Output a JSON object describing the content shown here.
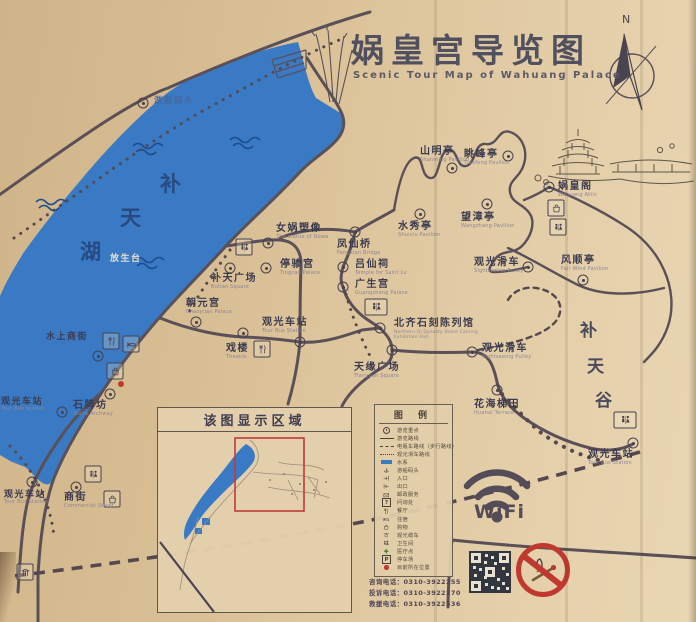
{
  "title": {
    "cn": "娲皇宫导览图",
    "en": "Scenic Tour Map of Wahuang Palace"
  },
  "compass": {
    "north": "N"
  },
  "lake": {
    "chars": [
      "补",
      "天",
      "湖"
    ],
    "color": "#3a7ac4"
  },
  "valley": {
    "chars": [
      "补",
      "天",
      "谷"
    ]
  },
  "pois": [
    {
      "cn": "游船码头",
      "en": ""
    },
    {
      "cn": "山明亭",
      "en": "Shanming Pavilion"
    },
    {
      "cn": "眺峰亭",
      "en": "Tiaofeng Pavilion"
    },
    {
      "cn": "娲皇阁",
      "en": "Wahuang Attic"
    },
    {
      "cn": "望漳亭",
      "en": "Wangzhang Pavilion"
    },
    {
      "cn": "水秀亭",
      "en": "Shuixiu Pavilion"
    },
    {
      "cn": "风顺亭",
      "en": "Fair Wind Pavilion"
    },
    {
      "cn": "观光滑车",
      "en": "Sightseeing Pulley"
    },
    {
      "cn": "女娲塑像",
      "en": "The statue of Nüwa"
    },
    {
      "cn": "凤仙桥",
      "en": "Fengxian Bridge"
    },
    {
      "cn": "停骖宫",
      "en": "Tingcan Palace"
    },
    {
      "cn": "吕仙祠",
      "en": "Temple for Saint Lu"
    },
    {
      "cn": "补天广场",
      "en": "Butian Square"
    },
    {
      "cn": "广生宫",
      "en": "Guangsheng Palace"
    },
    {
      "cn": "朝元宫",
      "en": "Chaoyuan Palace"
    },
    {
      "cn": "观光车站",
      "en": "Tour Bus Station"
    },
    {
      "cn": "戏楼",
      "en": "Theatre"
    },
    {
      "cn": "北齐石刻陈列馆",
      "en": "Northern Qi Dynasty Stone Carving Exhibition Hall"
    },
    {
      "cn": "天缘广场",
      "en": "Tianyuan Square"
    },
    {
      "cn": "观光滑车",
      "en": "Sightseeing Pulley"
    },
    {
      "cn": "花海梯田",
      "en": "Huahai Terrace"
    },
    {
      "cn": "石牌坊",
      "en": "Stone Archway"
    },
    {
      "cn": "观光车站",
      "en": "Tour Bus Station"
    },
    {
      "cn": "水上商街",
      "en": ""
    },
    {
      "cn": "放生台",
      "en": ""
    },
    {
      "cn": "观光车站",
      "en": "Tour Bus Station"
    },
    {
      "cn": "商街",
      "en": "Commercial Street"
    },
    {
      "cn": "观光车站",
      "en": "Tour Bus Station"
    }
  ],
  "legend": {
    "title": "图 例",
    "items": [
      {
        "label": "游览重点"
      },
      {
        "label": "游览路线"
      },
      {
        "label": "电瓶车路线（步行路线）"
      },
      {
        "label": "观光滑车路线"
      },
      {
        "label": "水系"
      },
      {
        "label": "游船码头"
      },
      {
        "label": "入口"
      },
      {
        "label": "出口"
      },
      {
        "label": "邮政服务"
      },
      {
        "label": "问询处",
        "sym": "?"
      },
      {
        "label": "餐厅"
      },
      {
        "label": "住宿"
      },
      {
        "label": "购物"
      },
      {
        "label": "观光缆车"
      },
      {
        "label": "卫生间"
      },
      {
        "label": "医疗点"
      },
      {
        "label": "停车场",
        "sym": "P"
      },
      {
        "label": "目前所在位置"
      }
    ]
  },
  "inset": {
    "title": "该图显示区域"
  },
  "wifi": {
    "label": "WiFi"
  },
  "phones": [
    "咨询电话：0310-3922255",
    "投诉电话：0310-3922270",
    "救援电话：0310-3922536"
  ],
  "colors": {
    "lake": "#3a7ac4",
    "road": "#5a5058",
    "accent_red": "#c0392f",
    "board": "#dcc39a"
  }
}
